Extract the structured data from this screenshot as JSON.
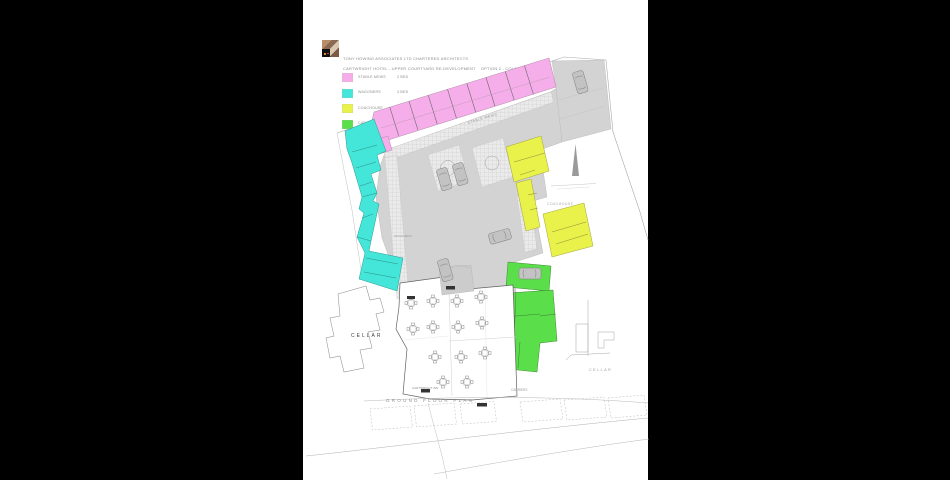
{
  "title_block": {
    "architect": "TONY HOWING ASSOCIATES LTD CHARTERED ARCHITECTS",
    "project": "CARTWRIGHT HOTEL - UPPER COURTYARD RE-DEVELOPMENT    OPTION 2 - COLOUR"
  },
  "legend": {
    "items": [
      {
        "label": "STABLE MEWS",
        "beds": "2 BED",
        "color": "#f6aeea"
      },
      {
        "label": "WAGONERS",
        "beds": "3 BED",
        "color": "#43e6d8"
      },
      {
        "label": "COACHOUSE",
        "beds": "2 BED",
        "color": "#e9f24b"
      },
      {
        "label": "CARRIERS",
        "beds": "3 BED",
        "color": "#5ade49"
      }
    ]
  },
  "plan": {
    "labels": {
      "stable_mews_street": "STABLE MEWS",
      "wagoners_unit": "WAGONERS",
      "coachouse_unit": "COACHOUSE",
      "carriers_unit": "CARRIERS",
      "cellar_left": "CELLAR",
      "cellar_right": "CELLAR",
      "cartwright_inn": "CARTWRIGHT INN",
      "ground_floor_plan": "GROUND FLOOR PLAN"
    },
    "colors": {
      "stable_mews": "#f6aeea",
      "wagoners": "#43e6d8",
      "coachouse": "#e9f24b",
      "carriers": "#5ade49",
      "courtyard": "#d3d3d3",
      "walkway": "#eaeaea",
      "wall": "#6a6a6a"
    }
  }
}
